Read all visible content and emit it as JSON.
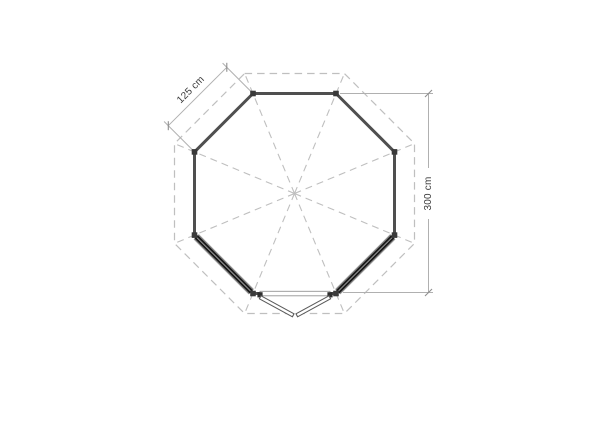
{
  "drawing": {
    "kind": "octagonal gazebo floor plan",
    "labels": {
      "side_dimension": "125 cm",
      "height_dimension": "300 cm"
    },
    "features": {
      "roof_outline": "dashed octagon with 8 hip lines from center",
      "windows": "two dark window walls on lower diagonals",
      "door": "double door opening outward at bottom wall"
    },
    "colors": {
      "wall": "#4f4f4f",
      "window": "#1c1c1c",
      "dashed_lines": "#bfbfbf",
      "dimension_lines": "#b0b0b0",
      "label_text": "#3a3a3a",
      "background": "#ffffff"
    }
  }
}
